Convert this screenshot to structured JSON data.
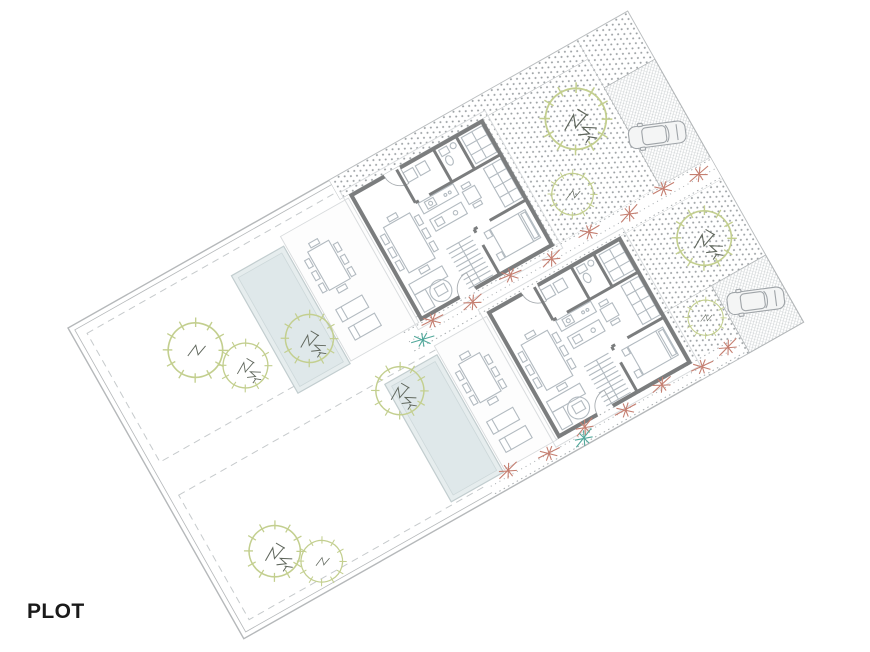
{
  "page": {
    "background": "#ffffff",
    "label": "PLOT"
  },
  "plan": {
    "type": "architectural-site-plan",
    "rotation_deg": -29.5,
    "plots": [
      {
        "id": "plot-1",
        "features": [
          "house",
          "swimming-pool",
          "terrace-with-outdoor-furniture",
          "lawn-garden",
          "garden-trees",
          "gravel-entry-court",
          "hatched-driveway",
          "parked-car",
          "red-flower-border"
        ]
      },
      {
        "id": "plot-2",
        "features": [
          "house",
          "swimming-pool",
          "terrace-with-outdoor-furniture",
          "lawn-garden",
          "garden-trees",
          "gravel-entry-court",
          "hatched-driveway",
          "parked-car",
          "red-flower-border"
        ]
      }
    ],
    "colors": {
      "boundary": "#b5b8ba",
      "wall": "#7b7d7e",
      "furniture_line": "#b2bac0",
      "door_line": "#a8adb1",
      "pool_fill": "#e6edee",
      "pool_water": "#dfe8ea",
      "pool_edge": "#c2cdcf",
      "terrace_edge": "#d8dbdd",
      "eaves_line": "#d9dcde",
      "tree_green": "#c3cf8f",
      "tree_branch": "#5f665c",
      "flower_red": "#c57f71",
      "flower_teal": "#52a89b",
      "gravel_dot": "#9ba0a3",
      "paving_hatch": "#cdd1d3",
      "dashed_line": "#c6cacc",
      "car_line": "#9fa4a8",
      "label_color": "#1a1a1a"
    }
  }
}
